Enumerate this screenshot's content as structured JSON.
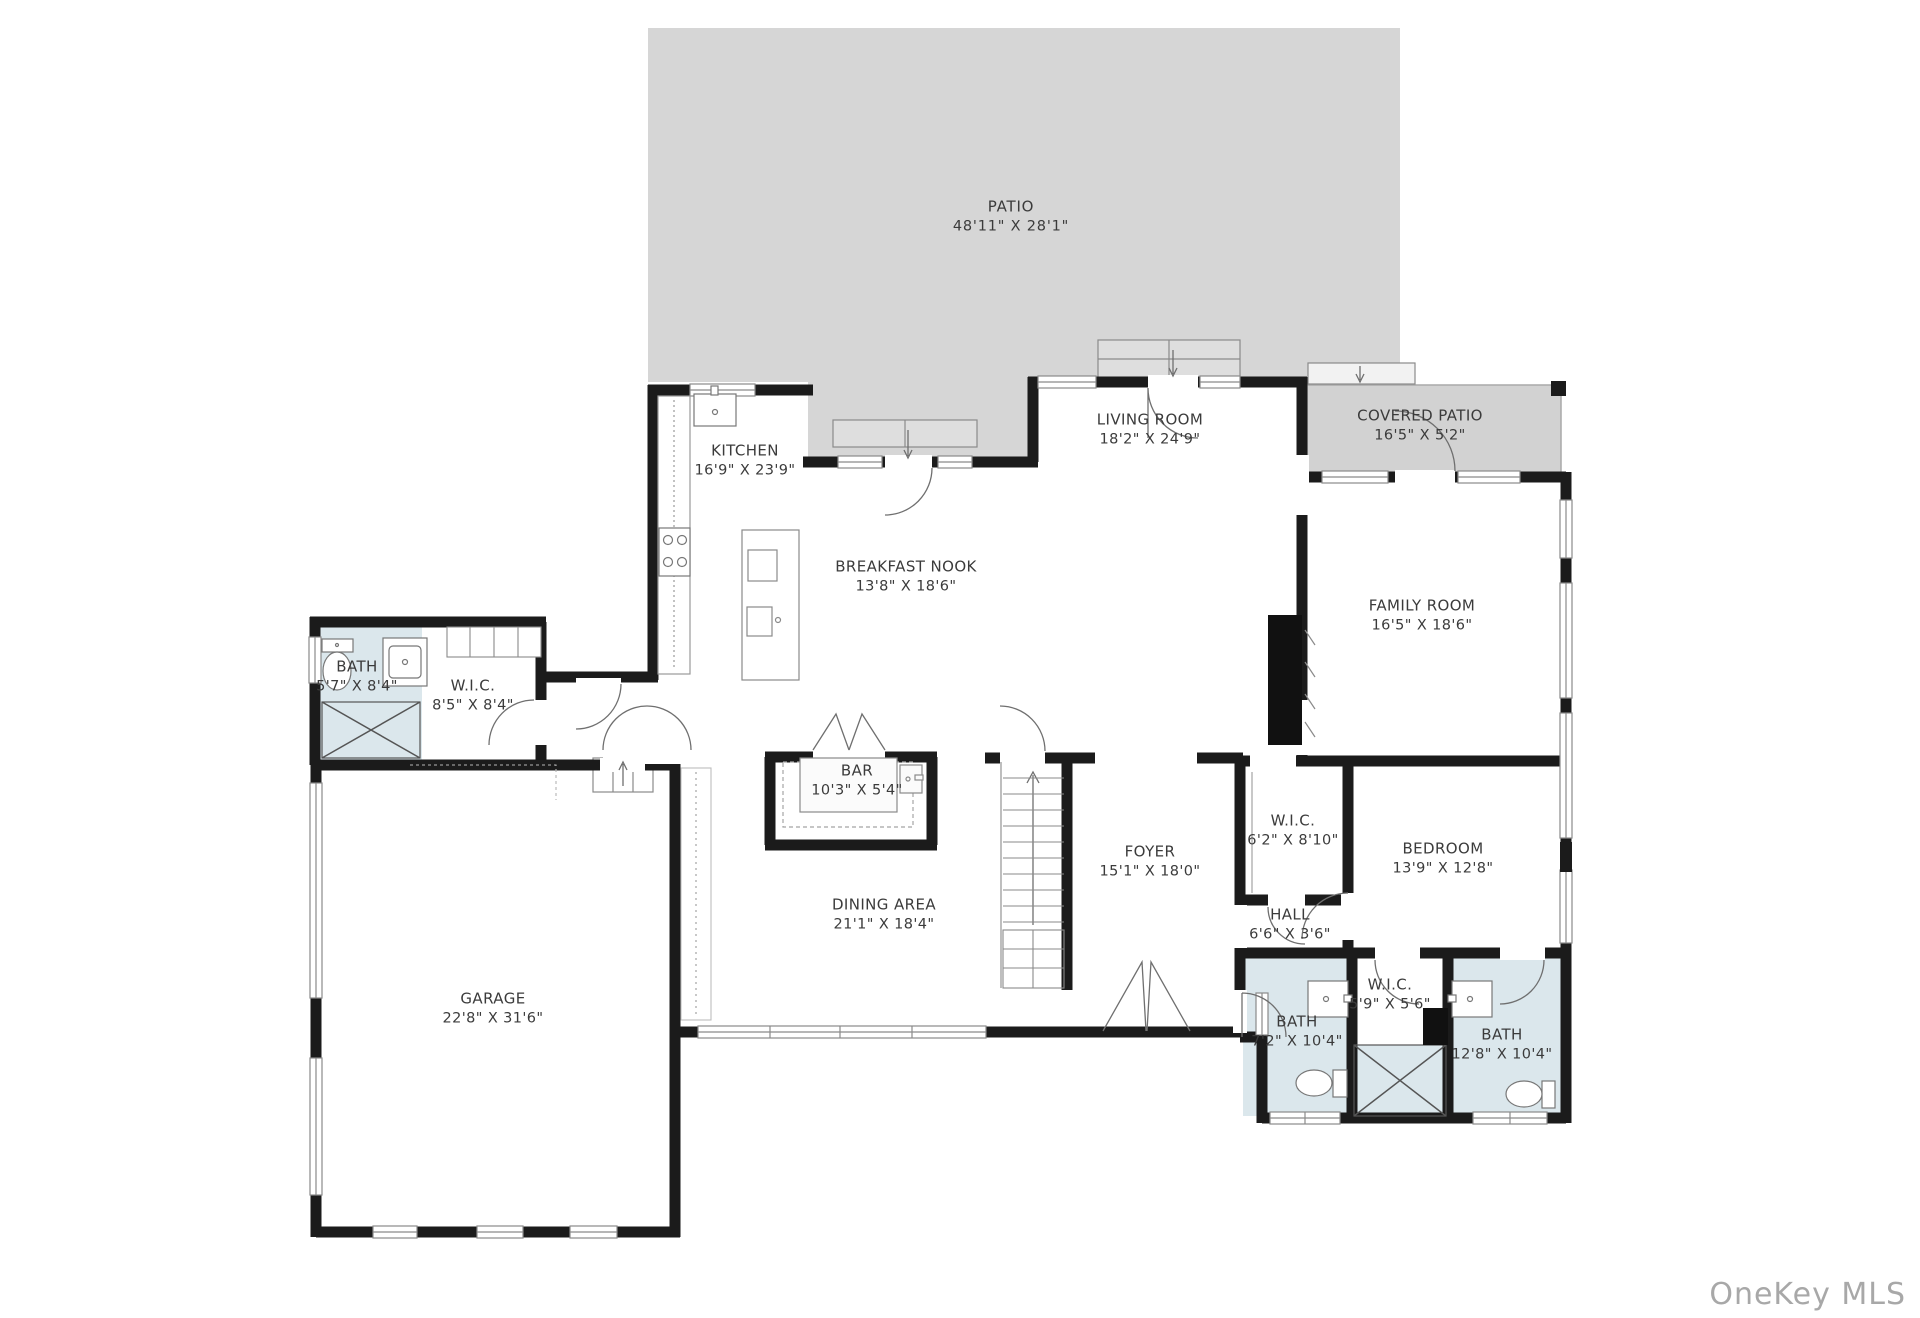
{
  "watermark": "OneKey MLS",
  "colors": {
    "wall": "#1b1b1b",
    "patio": "#d6d6d6",
    "covered_patio": "#d2d2d2",
    "bath_fill": "#dbe7ec",
    "steps_fill": "#dedede",
    "thin_line": "#777777",
    "label_text": "#3b3b3b",
    "watermark_text": "#a8a8a8"
  },
  "rooms": [
    {
      "name": "PATIO",
      "dims": "48'11\" X 28'1\""
    },
    {
      "name": "KITCHEN",
      "dims": "16'9\" X 23'9\""
    },
    {
      "name": "LIVING ROOM",
      "dims": "18'2\" X 24'9\""
    },
    {
      "name": "COVERED PATIO",
      "dims": "16'5\" X 5'2\""
    },
    {
      "name": "BREAKFAST NOOK",
      "dims": "13'8\" X 18'6\""
    },
    {
      "name": "FAMILY ROOM",
      "dims": "16'5\" X 18'6\""
    },
    {
      "name": "BATH",
      "dims": "5'7\" X 8'4\""
    },
    {
      "name": "W.I.C.",
      "dims": "8'5\" X 8'4\""
    },
    {
      "name": "BAR",
      "dims": "10'3\" X 5'4\""
    },
    {
      "name": "FOYER",
      "dims": "15'1\" X 18'0\""
    },
    {
      "name": "W.I.C.",
      "dims": "6'2\" X 8'10\""
    },
    {
      "name": "BEDROOM",
      "dims": "13'9\" X 12'8\""
    },
    {
      "name": "HALL",
      "dims": "6'6\" X 3'6\""
    },
    {
      "name": "DINING AREA",
      "dims": "21'1\" X 18'4\""
    },
    {
      "name": "GARAGE",
      "dims": "22'8\" X 31'6\""
    },
    {
      "name": "BATH",
      "dims": "7'2\" X 10'4\""
    },
    {
      "name": "W.I.C.",
      "dims": "5'9\" X 5'6\""
    },
    {
      "name": "BATH",
      "dims": "12'8\" X 10'4\""
    }
  ]
}
